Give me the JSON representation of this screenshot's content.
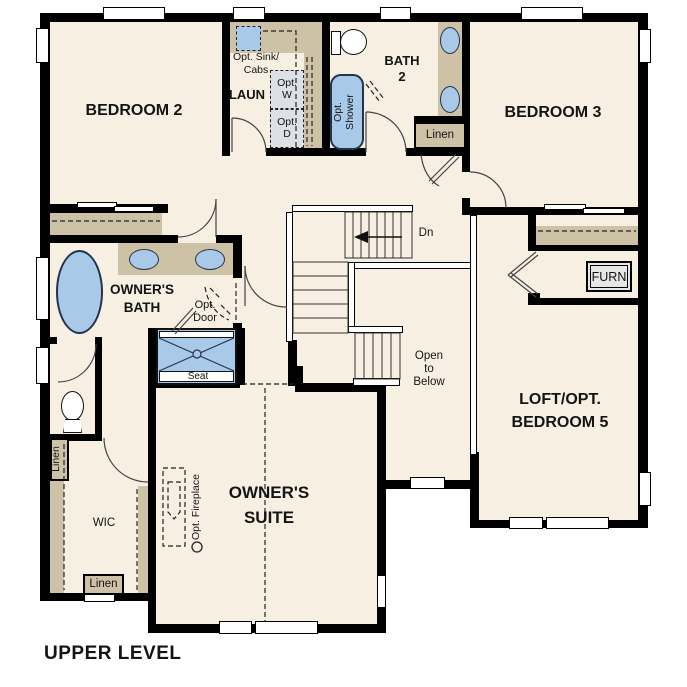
{
  "page_title": "UPPER LEVEL",
  "colors": {
    "floor": "#f6efe2",
    "wall": "#000000",
    "counter_tan": "#cdc1a6",
    "fixture_blue": "#a9c9e9",
    "fixture_outline": "#24344d",
    "appliance_gray": "#dde1e5"
  },
  "rooms": {
    "bedroom2": {
      "name": "BEDROOM 2"
    },
    "bedroom3": {
      "name": "BEDROOM 3"
    },
    "laundry": {
      "name": "LAUN",
      "opt_sink_line1": "Opt. Sink/",
      "opt_sink_line2": "Cabs",
      "opt_washer_line1": "Opt.",
      "opt_washer_line2": "W",
      "opt_dryer_line1": "Opt.",
      "opt_dryer_line2": "D"
    },
    "bath2": {
      "name_line1": "BATH",
      "name_line2": "2",
      "opt_shower_line1": "Opt.",
      "opt_shower_line2": "Shower",
      "linen": "Linen"
    },
    "furnace_closet": {
      "label": "FURN"
    },
    "stairs": {
      "direction_label": "Dn"
    },
    "open_to_below": {
      "line1": "Open",
      "line2": "to",
      "line3": "Below"
    },
    "loft": {
      "name_line1": "LOFT/OPT.",
      "name_line2": "BEDROOM 5"
    },
    "owners_bath": {
      "name_line1": "OWNER'S",
      "name_line2": "BATH",
      "opt_door_line1": "Opt.",
      "opt_door_line2": "Door",
      "shower_seat": "Seat"
    },
    "hall_linen": {
      "label": "Linen"
    },
    "wic": {
      "name": "WIC",
      "linen": "Linen"
    },
    "owners_suite": {
      "name_line1": "OWNER'S",
      "name_line2": "SUITE",
      "opt_fireplace": "Opt. Fireplace"
    }
  }
}
